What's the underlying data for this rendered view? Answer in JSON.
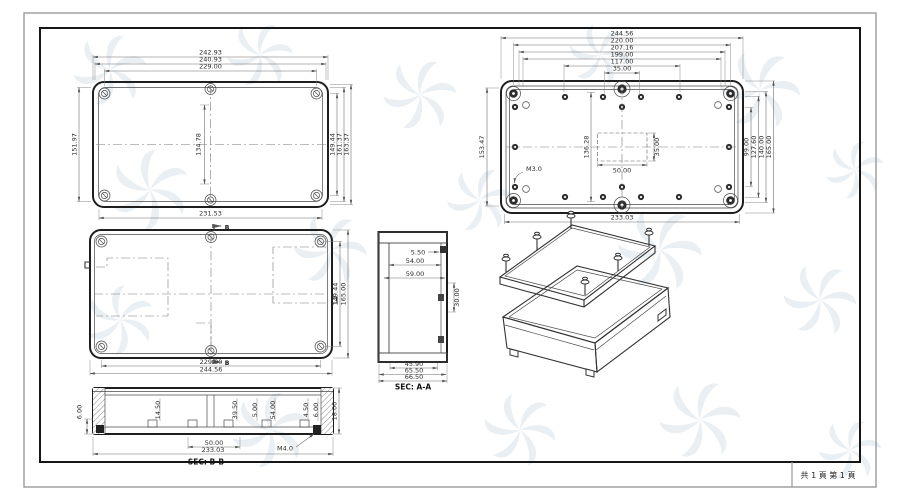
{
  "footer": {
    "pages": "共 1 頁  第 1 頁"
  },
  "views": {
    "lid_top": {
      "dims_top": [
        "242.93",
        "240.93",
        "229.00"
      ],
      "dim_left": "151.97",
      "dim_center": "134.78",
      "dims_right": [
        "149.44",
        "161.37",
        "163.37"
      ],
      "dim_bottom": "231.53"
    },
    "base_bottom": {
      "dims_top": [
        "244.56",
        "220.00",
        "207.16",
        "199.00",
        "117.00",
        "35.00"
      ],
      "dim_left": "153.47",
      "dim_inner_left": "136.28",
      "dims_right": [
        "99.00",
        "127.60",
        "140.00",
        "165.00"
      ],
      "dim_bottom": "233.03",
      "dim_cutout_w": "50.00",
      "dim_cutout_h": "35.00",
      "thread_note": "M3.0"
    },
    "lid_inner": {
      "dims_right": [
        "149.44",
        "165.00"
      ],
      "dims_bottom": [
        "229.00",
        "244.56"
      ],
      "section_marker": "B"
    },
    "section_aa": {
      "label": "SEC: A-A",
      "dim_lip": "5.50",
      "dims_width": [
        "54.00",
        "59.00"
      ],
      "dim_right": "30.00",
      "dims_bottom": [
        "45.90",
        "65.50",
        "66.50"
      ]
    },
    "section_bb": {
      "label": "SEC: B-B",
      "dim_left": "6.00",
      "dims_inner": [
        "14.50",
        "39.50",
        "5.00",
        "54.00",
        "4.50",
        "6.00"
      ],
      "dim_right": "18.00",
      "dims_bottom": [
        "50.00",
        "233.03"
      ],
      "thread_note": "M4.0"
    }
  }
}
